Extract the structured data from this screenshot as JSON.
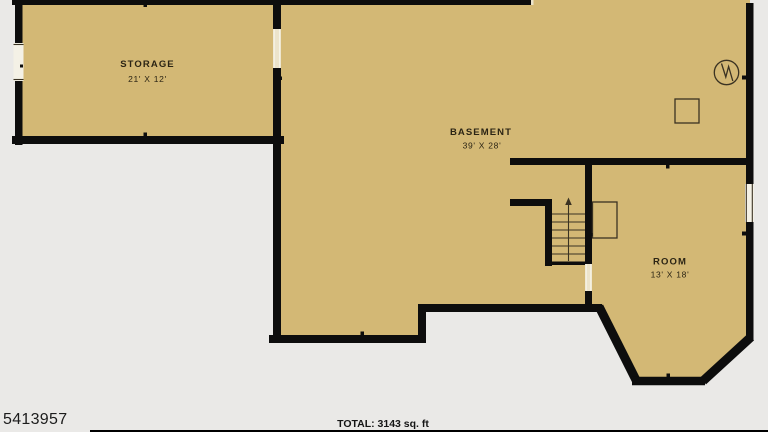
{
  "plan": {
    "rooms": [
      {
        "name": "STORAGE",
        "dims": "21' X 12'"
      },
      {
        "name": "BASEMENT",
        "dims": "39' X 28'"
      },
      {
        "name": "ROOM",
        "dims": "13' X 18'"
      }
    ],
    "symbols": [
      {
        "name": "water-heater-icon",
        "shape": "circle-with-zigzag"
      },
      {
        "name": "utility-box-icon",
        "shape": "square-outline"
      },
      {
        "name": "stairs",
        "direction": "up"
      }
    ]
  },
  "footer": {
    "listing_id": "5413957",
    "total": "TOTAL: 3143 sq. ft"
  },
  "colors": {
    "background": "#eae9e7",
    "floor_fill": "#d3b875",
    "wall": "#0d0d0d",
    "detail_stroke": "#3a3222",
    "label_text": "#2b2414",
    "door_fill": "#ece4cb",
    "window_fill": "#f4f1e6",
    "footer_text": "#1c1c1c"
  }
}
